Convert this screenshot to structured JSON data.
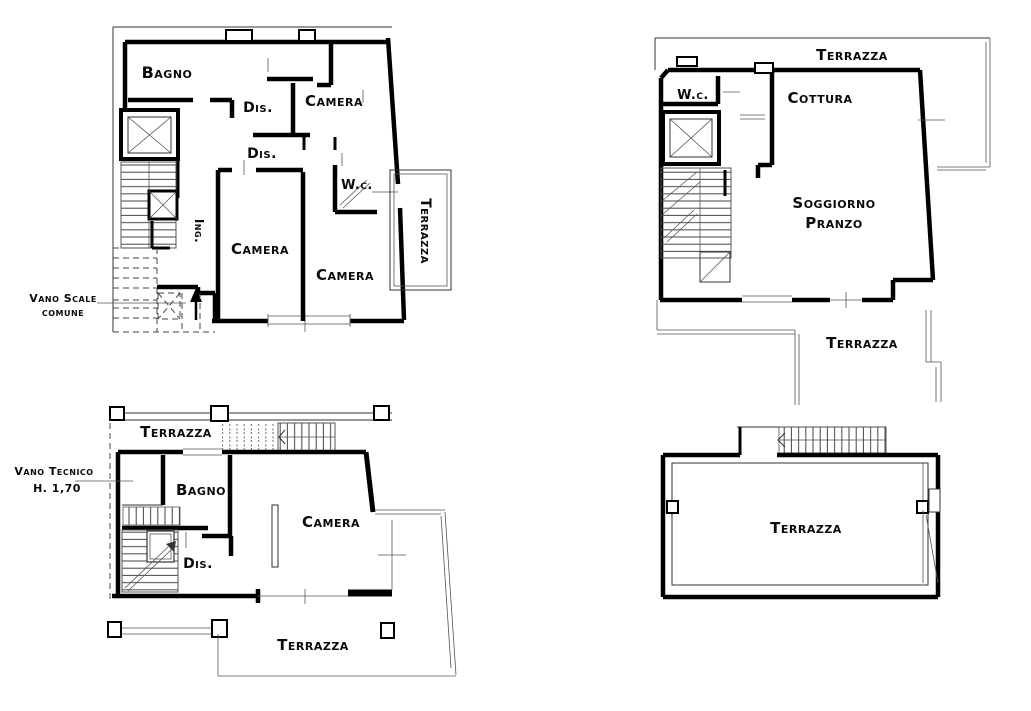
{
  "drawing": {
    "type": "architectural-floor-plans",
    "background_color": "#ffffff",
    "line_color": "#000000",
    "plans": 4
  },
  "plans": {
    "top_left": {
      "rooms": {
        "bagno": "Bagno",
        "dis_1": "Dis.",
        "camera_1": "Camera",
        "dis_2": "Dis.",
        "wc": "W.c.",
        "camera_2": "Camera",
        "camera_3": "Camera",
        "ing": "Ing.",
        "terrazza": "Terrazza"
      },
      "annotations": {
        "vano_scale_line_1": "Vano Scale",
        "vano_scale_line_2": "comune"
      }
    },
    "top_right": {
      "rooms": {
        "terrazza_nord": "Terrazza",
        "wc": "W.c.",
        "cottura": "Cottura",
        "soggiorno_line_1": "Soggiorno",
        "soggiorno_line_2": "Pranzo",
        "terrazza_sud": "Terrazza"
      }
    },
    "bottom_left": {
      "rooms": {
        "terrazza_nord": "Terrazza",
        "bagno": "Bagno",
        "dis": "Dis.",
        "camera": "Camera",
        "terrazza_sud": "Terrazza"
      },
      "annotations": {
        "vano_tecnico_line_1": "Vano Tecnico",
        "vano_tecnico_line_2": "H. 1,70"
      }
    },
    "bottom_right": {
      "rooms": {
        "terrazza": "Terrazza"
      }
    }
  }
}
